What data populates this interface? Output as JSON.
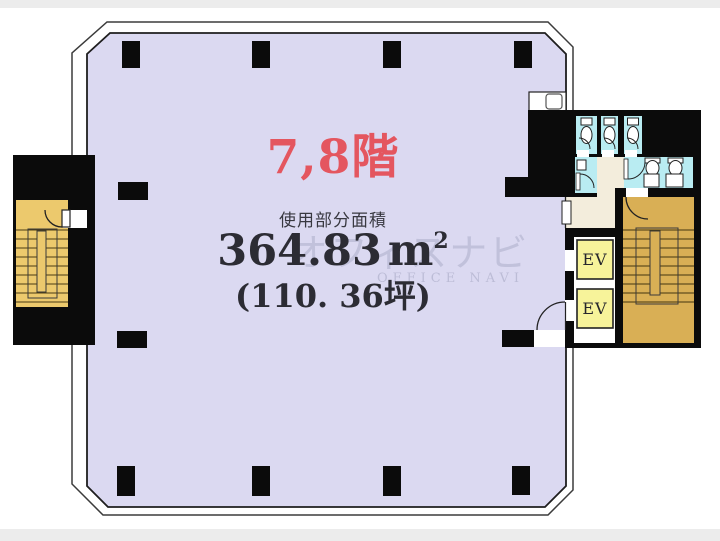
{
  "labels": {
    "floor_title": "7,8階",
    "area_caption": "使用部分面積",
    "area_sqm_value": "364.83",
    "area_sqm_unit": "m",
    "area_sqm_sup": "2",
    "area_tsubo": "(110. 36坪)"
  },
  "elevators": [
    {
      "label": "EV"
    },
    {
      "label": "EV"
    }
  ],
  "watermark": {
    "line1": "オフィスナビ",
    "line2": "OFFICE NAVI"
  },
  "colors": {
    "room": "#dbd9f1",
    "wall": "#0b0b0b",
    "wc": "#b9ecf2",
    "hall": "#f3eddc",
    "ev": "#f7f39a",
    "stair_left": "#ecc96d",
    "stair_right": "#d9af55",
    "accent": "#e4565f",
    "ink": "#2c2c34",
    "frame": "#ececec"
  }
}
